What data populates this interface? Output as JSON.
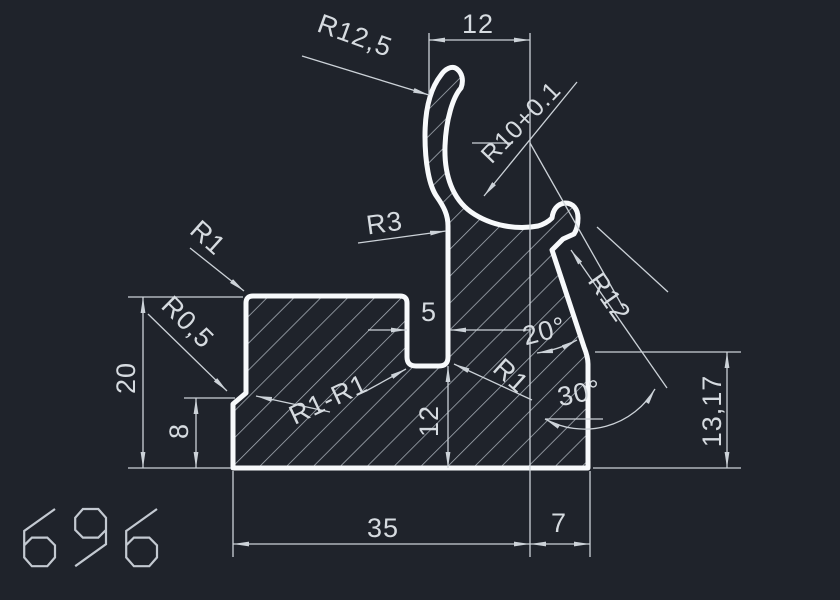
{
  "drawing": {
    "part_number": "696",
    "dimensions": {
      "opening_width": "12",
      "slot_width": "5",
      "slot_depth": "12",
      "overall_height": "20",
      "step_height": "8",
      "base_width": "35",
      "base_right_width": "7",
      "right_height": "13,17"
    },
    "radius_labels": {
      "outer_lip": "R12,5",
      "bore": "R10+0.1",
      "stem_fillet": "R3",
      "top_left_corner": "R1",
      "step_fillet": "R0,5",
      "slot_fillets": "R1-R1",
      "inner_right_fillet": "R1",
      "right_edge": "R12"
    },
    "angle_labels": {
      "upper": "20°",
      "lower": "30°"
    },
    "colors": {
      "background": "#1f232b",
      "outline": "#f7f9fb",
      "hatch": "#aab1ba",
      "dimline": "#ccd2d8",
      "dimtext": "#d6dbe0",
      "partnumber": "#c3c9d1"
    }
  }
}
